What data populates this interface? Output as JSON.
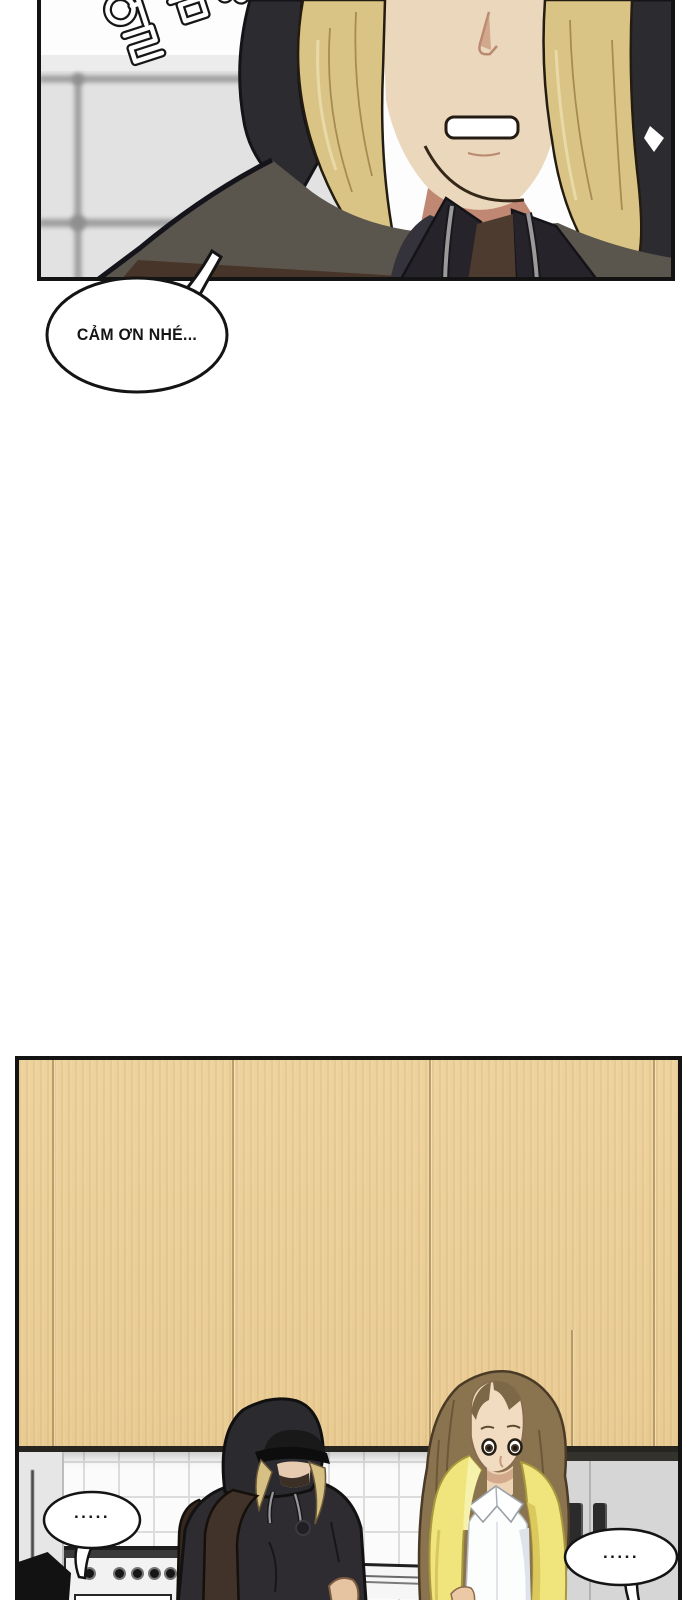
{
  "panel1": {
    "sfx_text": "얼음..",
    "bubble_text": "CẢM ƠN NHÉ...",
    "colors": {
      "wall": "#e3e3e3",
      "window_frame": "#9e9e9e",
      "hood": "#2c2b30",
      "jacket": "#34323a",
      "shoulder": "#5a554d",
      "inner_lining": "#4a3a2c",
      "hair_blonde": "#d9c486",
      "skin": "#ead7bc",
      "neck_shadow": "#c08873",
      "drawstring": "#9a9a9a",
      "bubble_fill": "#ffffff",
      "line": "#141414"
    }
  },
  "panel2": {
    "left_bubble_text": ".....",
    "right_bubble_text": ".....",
    "colors": {
      "cabinet_wood": "#ebcf98",
      "wood_seam": "#c9ac74",
      "under_cabinet_shadow": "#26251f",
      "tile": "#fbfbfb",
      "tile_line": "#dcdcdc",
      "gray_unit": "#d6d6d6",
      "handle": "#2b2b2b",
      "stove": "#f2f2f2",
      "hoodie": "#2e2c31",
      "cap": "#0d0d0d",
      "backpack": "#41322a",
      "hair_blonde": "#d6c083",
      "hair_brown": "#8a744f",
      "skin": "#f1dcc2",
      "cardigan_yellow": "#efe57c",
      "shirt": "#fcfdfd"
    }
  }
}
